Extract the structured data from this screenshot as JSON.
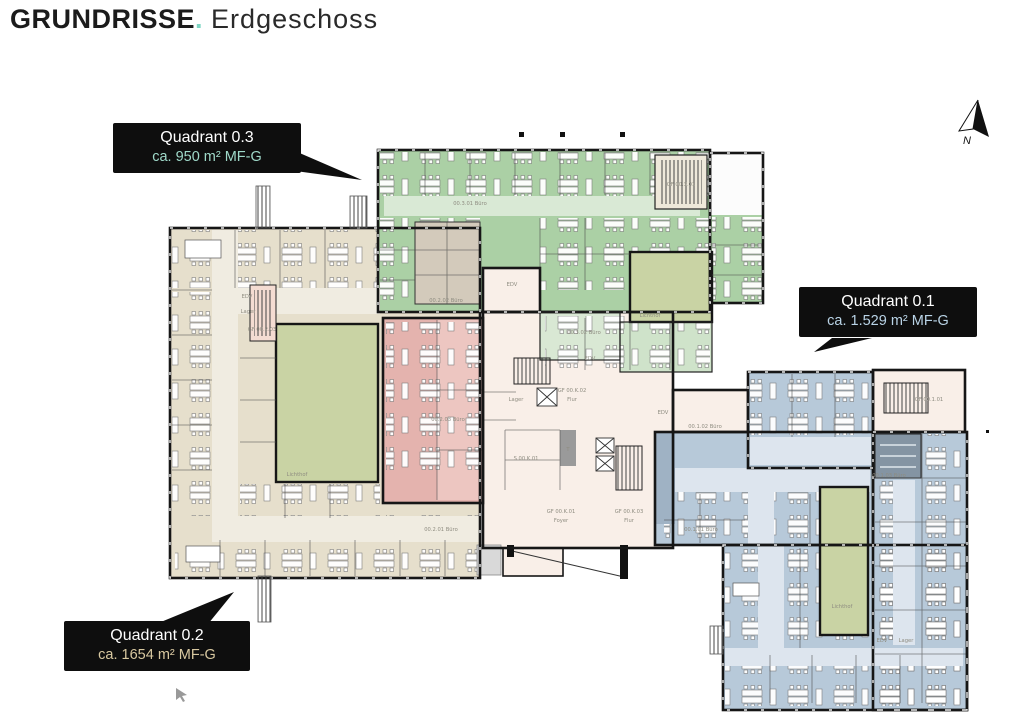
{
  "page": {
    "title_main": "GRUNDRISSE",
    "title_dot": ".",
    "title_sub": "Erdgeschoss"
  },
  "compass": {
    "label": "N"
  },
  "callouts": [
    {
      "name": "quadrant-0.3",
      "line1": "Quadrant 0.3",
      "line2": "ca. 950 m² MF-G",
      "accent": "#9fd9c9"
    },
    {
      "name": "quadrant-0.1",
      "line1": "Quadrant 0.1",
      "line2": "ca. 1.529 m² MF-G",
      "accent": "#b9d3e6"
    },
    {
      "name": "quadrant-0.2",
      "line1": "Quadrant 0.2",
      "line2": "ca. 1654 m² MF-G",
      "accent": "#d8c8a0"
    }
  ],
  "colors": {
    "green_room": "#abd0a5",
    "green_corridor": "#d9e9d5",
    "olive_courtyard": "#c9d3a4",
    "beige_room": "#e6dfcc",
    "beige_corridor": "#f0ece1",
    "red_room": "#e4b3ae",
    "pink_core": "#f9efe8",
    "blue_room": "#b7c9d9",
    "blue_corridor": "#dde5ee",
    "wall": "#161616",
    "callout_bg": "#0e0e0e",
    "title_dot": "#7fd6c4"
  },
  "plan": {
    "labels": [
      {
        "text": "00.3.01 Büro",
        "x": 470,
        "y": 205
      },
      {
        "text": "GF 00.3.01",
        "x": 681,
        "y": 186,
        "c": "#6b6b6b"
      },
      {
        "text": "EDV",
        "x": 512,
        "y": 286
      },
      {
        "text": "00.3.02 Büro",
        "x": 584,
        "y": 334
      },
      {
        "text": "Lichthof",
        "x": 650,
        "y": 317,
        "c": "#6f7a5f"
      },
      {
        "text": "00.2.02 Büro",
        "x": 446,
        "y": 302
      },
      {
        "text": "00.2.03 Büro",
        "x": 448,
        "y": 421,
        "c": "#97837f"
      },
      {
        "text": "Lichthof",
        "x": 297,
        "y": 476,
        "c": "#6f7a5f"
      },
      {
        "text": "00.2.01 Büro",
        "x": 441,
        "y": 531
      },
      {
        "text": "EDV",
        "x": 247,
        "y": 298
      },
      {
        "text": "Lager",
        "x": 248,
        "y": 313
      },
      {
        "text": "GF 00.2.03",
        "x": 262,
        "y": 331,
        "c": "#6b6b6b"
      },
      {
        "text": "Lager",
        "x": 516,
        "y": 401
      },
      {
        "text": "GF 00.K.02",
        "x": 572,
        "y": 392,
        "c": "#6b6b6b"
      },
      {
        "text": "Flur",
        "x": 572,
        "y": 401,
        "c": "#6b6b6b"
      },
      {
        "text": "S 00.K.01",
        "x": 526,
        "y": 460,
        "c": "#6b6b6b"
      },
      {
        "text": "T",
        "x": 568,
        "y": 451,
        "c": "#f2f2f2"
      },
      {
        "text": "GF 00.K.01",
        "x": 561,
        "y": 513,
        "c": "#6b6b6b"
      },
      {
        "text": "Foyer",
        "x": 561,
        "y": 522,
        "c": "#6b6b6b"
      },
      {
        "text": "GF 00.K.03",
        "x": 629,
        "y": 513,
        "c": "#6b6b6b"
      },
      {
        "text": "Flur",
        "x": 629,
        "y": 522,
        "c": "#6b6b6b"
      },
      {
        "text": "EDV",
        "x": 663,
        "y": 414
      },
      {
        "text": "EDV",
        "x": 590,
        "y": 360
      },
      {
        "text": "00.1.02 Büro",
        "x": 705,
        "y": 428
      },
      {
        "text": "GF 00.1.01",
        "x": 929,
        "y": 401,
        "c": "#6b6b6b"
      },
      {
        "text": "00.1.03 Büro",
        "x": 889,
        "y": 477
      },
      {
        "text": "00.1.01 Büro",
        "x": 701,
        "y": 531
      },
      {
        "text": "Lichthof",
        "x": 842,
        "y": 608,
        "c": "#6f7a5f"
      },
      {
        "text": "EDV",
        "x": 882,
        "y": 642
      },
      {
        "text": "Lager",
        "x": 906,
        "y": 642
      }
    ]
  }
}
